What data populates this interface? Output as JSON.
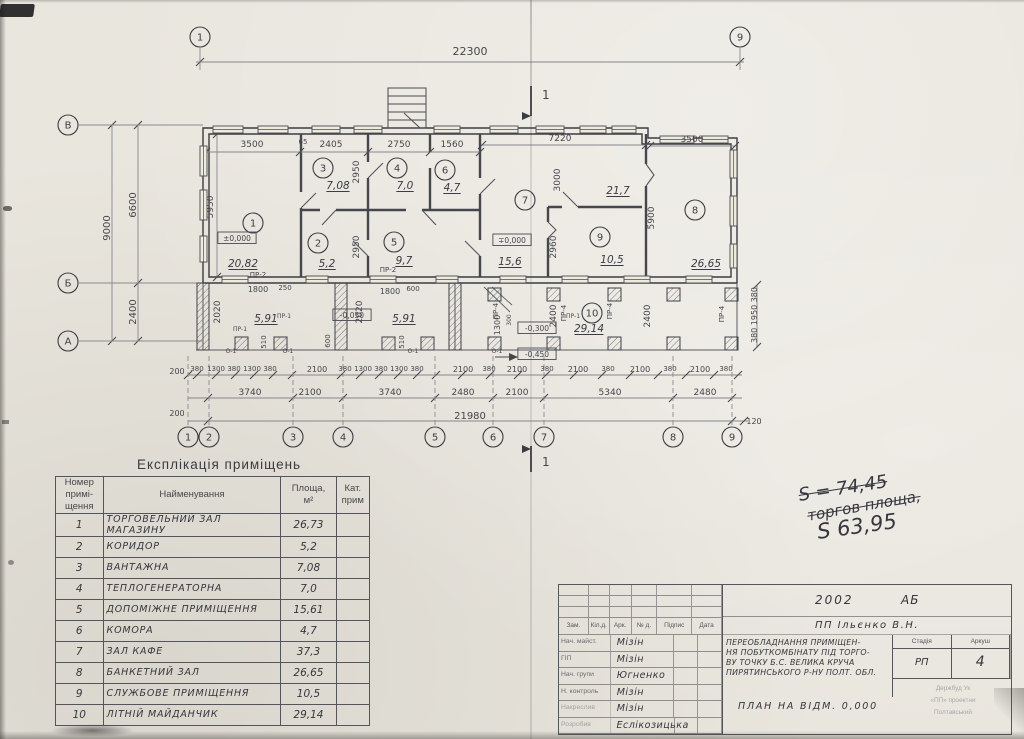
{
  "colors": {
    "paper": "#e9e6de",
    "ink": "#3c3d44",
    "line_light": "#86878c",
    "hand_ink": "#35363e"
  },
  "plan": {
    "overall_width_dim": "22300",
    "section_mark": "1",
    "axes_top": [
      {
        "label": "1",
        "x": 200
      },
      {
        "label": "9",
        "x": 740
      }
    ],
    "axes_bottom": [
      {
        "label": "1",
        "x": 188
      },
      {
        "label": "2",
        "x": 209
      },
      {
        "label": "3",
        "x": 293
      },
      {
        "label": "4",
        "x": 343
      },
      {
        "label": "5",
        "x": 435
      },
      {
        "label": "6",
        "x": 493
      },
      {
        "label": "7",
        "x": 544
      },
      {
        "label": "8",
        "x": 673
      },
      {
        "label": "9",
        "x": 732
      }
    ],
    "axes_left": [
      {
        "label": "В",
        "y": 125
      },
      {
        "label": "Б",
        "y": 283
      },
      {
        "label": "А",
        "y": 341
      }
    ],
    "rooms": [
      {
        "num": "1",
        "cx": 253,
        "cy": 223,
        "area": "20,82",
        "ax": 243,
        "ay": 267
      },
      {
        "num": "2",
        "cx": 318,
        "cy": 243,
        "area": "5,2",
        "ax": 327,
        "ay": 267
      },
      {
        "num": "3",
        "cx": 323,
        "cy": 168,
        "area": "7,08",
        "ax": 338,
        "ay": 189
      },
      {
        "num": "4",
        "cx": 397,
        "cy": 168,
        "area": "7,0",
        "ax": 405,
        "ay": 189
      },
      {
        "num": "5",
        "cx": 394,
        "cy": 242,
        "area": "9,7",
        "ax": 404,
        "ay": 264
      },
      {
        "num": "6",
        "cx": 445,
        "cy": 170,
        "area": "4,7",
        "ax": 452,
        "ay": 191
      },
      {
        "num": "7",
        "cx": 525,
        "cy": 200,
        "area": "15,6",
        "ax": 510,
        "ay": 265
      },
      {
        "num": "8",
        "cx": 695,
        "cy": 210,
        "area": "26,65",
        "ax": 706,
        "ay": 267
      },
      {
        "num": "9",
        "cx": 600,
        "cy": 237,
        "area": "10,5",
        "ax": 612,
        "ay": 263
      },
      {
        "num": "10",
        "cx": 592,
        "cy": 313,
        "area": "29,14",
        "ax": 589,
        "ay": 332
      }
    ],
    "area_labels": [
      {
        "t": "21,7",
        "x": 618,
        "y": 194
      },
      {
        "t": "5,91",
        "x": 266,
        "y": 322
      },
      {
        "t": "5,91",
        "x": 404,
        "y": 322
      }
    ],
    "levels": [
      {
        "t": "±0,000",
        "x": 237,
        "y": 241
      },
      {
        "t": "∓0,000",
        "x": 512,
        "y": 243
      },
      {
        "t": "-0,050",
        "x": 352,
        "y": 318
      },
      {
        "t": "-0,300",
        "x": 537,
        "y": 331
      },
      {
        "t": "-0,450",
        "x": 537,
        "y": 357,
        "arrow": true
      }
    ],
    "dim_labels": [
      {
        "t": "22300",
        "x": 470,
        "y": 55,
        "s": 11
      },
      {
        "t": "3500",
        "x": 252,
        "y": 147,
        "s": 9
      },
      {
        "t": "65",
        "x": 303,
        "y": 144,
        "s": 7
      },
      {
        "t": "2405",
        "x": 331,
        "y": 147,
        "s": 9
      },
      {
        "t": "2750",
        "x": 399,
        "y": 147,
        "s": 9
      },
      {
        "t": "1560",
        "x": 452,
        "y": 147,
        "s": 9
      },
      {
        "t": "7220",
        "x": 560,
        "y": 141,
        "s": 9
      },
      {
        "t": "3500",
        "x": 692,
        "y": 142,
        "s": 9
      },
      {
        "t": "9000",
        "x": 110,
        "y": 228,
        "r": -90,
        "s": 10
      },
      {
        "t": "6600",
        "x": 136,
        "y": 205,
        "r": -90,
        "s": 10
      },
      {
        "t": "2400",
        "x": 136,
        "y": 312,
        "r": -90,
        "s": 10
      },
      {
        "t": "5950",
        "x": 213,
        "y": 207,
        "r": -90,
        "s": 9
      },
      {
        "t": "2950",
        "x": 359,
        "y": 172,
        "r": -90,
        "s": 9
      },
      {
        "t": "2950",
        "x": 359,
        "y": 247,
        "r": -90,
        "s": 9
      },
      {
        "t": "3000",
        "x": 560,
        "y": 180,
        "r": -90,
        "s": 9
      },
      {
        "t": "5900",
        "x": 654,
        "y": 218,
        "r": -90,
        "s": 9
      },
      {
        "t": "2960",
        "x": 556,
        "y": 247,
        "r": -90,
        "s": 9
      },
      {
        "t": "2020",
        "x": 220,
        "y": 312,
        "r": -90,
        "s": 9
      },
      {
        "t": "2020",
        "x": 362,
        "y": 312,
        "r": -90,
        "s": 9
      },
      {
        "t": "2400",
        "x": 556,
        "y": 316,
        "r": -90,
        "s": 9
      },
      {
        "t": "2400",
        "x": 650,
        "y": 316,
        "r": -90,
        "s": 9
      },
      {
        "t": "1300",
        "x": 500,
        "y": 325,
        "r": -90,
        "s": 8
      },
      {
        "t": "300",
        "x": 511,
        "y": 320,
        "r": -90,
        "s": 6
      },
      {
        "t": "1800",
        "x": 258,
        "y": 292,
        "s": 8
      },
      {
        "t": "250",
        "x": 285,
        "y": 290,
        "s": 7
      },
      {
        "t": "1800",
        "x": 390,
        "y": 294,
        "s": 8
      },
      {
        "t": "600",
        "x": 413,
        "y": 291,
        "s": 7
      },
      {
        "t": "510",
        "x": 266,
        "y": 342,
        "r": -90,
        "s": 7
      },
      {
        "t": "510",
        "x": 404,
        "y": 342,
        "r": -90,
        "s": 7
      },
      {
        "t": "600",
        "x": 330,
        "y": 341,
        "r": -90,
        "s": 7
      },
      {
        "t": "380 1950 380",
        "x": 757,
        "y": 315,
        "r": -90,
        "s": 8
      },
      {
        "t": "120",
        "x": 754,
        "y": 424,
        "s": 8
      },
      {
        "t": "200",
        "x": 177,
        "y": 374,
        "s": 8
      },
      {
        "t": "200",
        "x": 177,
        "y": 416,
        "s": 8
      },
      {
        "t": "380",
        "x": 197,
        "y": 371,
        "s": 7
      },
      {
        "t": "1300",
        "x": 216,
        "y": 371,
        "s": 7
      },
      {
        "t": "380",
        "x": 234,
        "y": 371,
        "s": 7
      },
      {
        "t": "1300",
        "x": 252,
        "y": 371,
        "s": 7
      },
      {
        "t": "380",
        "x": 270,
        "y": 371,
        "s": 7
      },
      {
        "t": "2100",
        "x": 317,
        "y": 372,
        "s": 8
      },
      {
        "t": "380",
        "x": 345,
        "y": 371,
        "s": 7
      },
      {
        "t": "1300",
        "x": 363,
        "y": 371,
        "s": 7
      },
      {
        "t": "380",
        "x": 381,
        "y": 371,
        "s": 7
      },
      {
        "t": "1300",
        "x": 399,
        "y": 371,
        "s": 7
      },
      {
        "t": "380",
        "x": 417,
        "y": 371,
        "s": 7
      },
      {
        "t": "2100",
        "x": 463,
        "y": 372,
        "s": 8
      },
      {
        "t": "380",
        "x": 489,
        "y": 371,
        "s": 7
      },
      {
        "t": "2100",
        "x": 517,
        "y": 372,
        "s": 8
      },
      {
        "t": "380",
        "x": 547,
        "y": 371,
        "s": 7
      },
      {
        "t": "2100",
        "x": 578,
        "y": 372,
        "s": 8
      },
      {
        "t": "380",
        "x": 608,
        "y": 371,
        "s": 7
      },
      {
        "t": "2100",
        "x": 640,
        "y": 372,
        "s": 8
      },
      {
        "t": "380",
        "x": 670,
        "y": 371,
        "s": 7
      },
      {
        "t": "2100",
        "x": 700,
        "y": 372,
        "s": 8
      },
      {
        "t": "380",
        "x": 726,
        "y": 371,
        "s": 7
      },
      {
        "t": "3740",
        "x": 250,
        "y": 395,
        "s": 9
      },
      {
        "t": "2100",
        "x": 310,
        "y": 395,
        "s": 9
      },
      {
        "t": "3740",
        "x": 390,
        "y": 395,
        "s": 9
      },
      {
        "t": "2480",
        "x": 463,
        "y": 395,
        "s": 9
      },
      {
        "t": "2100",
        "x": 517,
        "y": 395,
        "s": 9
      },
      {
        "t": "5340",
        "x": 610,
        "y": 395,
        "s": 9
      },
      {
        "t": "2480",
        "x": 705,
        "y": 395,
        "s": 9
      },
      {
        "t": "21980",
        "x": 470,
        "y": 419,
        "s": 10
      }
    ],
    "marks": [
      {
        "t": "ПР-2",
        "x": 258,
        "y": 277,
        "s": 7
      },
      {
        "t": "ПР-2",
        "x": 388,
        "y": 272,
        "s": 7
      },
      {
        "t": "ПР-1",
        "x": 240,
        "y": 331,
        "s": 6
      },
      {
        "t": "ПР-1",
        "x": 284,
        "y": 318,
        "s": 6
      },
      {
        "t": "ПР-1",
        "x": 573,
        "y": 318,
        "s": 6
      },
      {
        "t": "ПР-4",
        "x": 498,
        "y": 311,
        "r": -90,
        "s": 7
      },
      {
        "t": "ПР-4",
        "x": 566,
        "y": 313,
        "r": -90,
        "s": 7
      },
      {
        "t": "ПР-4",
        "x": 612,
        "y": 311,
        "r": -90,
        "s": 7
      },
      {
        "t": "ПР-4",
        "x": 724,
        "y": 314,
        "r": -90,
        "s": 7
      },
      {
        "t": "О-1",
        "x": 231,
        "y": 353,
        "s": 6
      },
      {
        "t": "О-1",
        "x": 288,
        "y": 353,
        "s": 6
      },
      {
        "t": "О-1",
        "x": 413,
        "y": 353,
        "s": 6
      },
      {
        "t": "О-1",
        "x": 497,
        "y": 353,
        "s": 6
      }
    ]
  },
  "table": {
    "title": "Експлікація приміщень",
    "headers": {
      "num": "Номер\nпримі-\nщення",
      "name": "Найменування",
      "area": "Площа,\nм²",
      "cat": "Кат.\nприм"
    },
    "rows": [
      [
        "1",
        "Торговельний зал магазину",
        "26,73"
      ],
      [
        "2",
        "Коридор",
        "5,2"
      ],
      [
        "3",
        "Вантажна",
        "7,08"
      ],
      [
        "4",
        "Теплогенераторна",
        "7,0"
      ],
      [
        "5",
        "Допоміжне приміщення",
        "15,61"
      ],
      [
        "6",
        "Комора",
        "4,7"
      ],
      [
        "7",
        "Зал кафе",
        "37,3"
      ],
      [
        "8",
        "Банкетний зал",
        "26,65"
      ],
      [
        "9",
        "Службове приміщення",
        "10,5"
      ],
      [
        "10",
        "Літній майданчик",
        "29,14"
      ]
    ]
  },
  "notes": {
    "line1": "S = 74,45",
    "line2": "торгов площа,",
    "line3": "S 63,95"
  },
  "title_block": {
    "year": "2002",
    "code": "АБ",
    "firm": "ПП Ільєнко В.Н.",
    "cols": [
      "Зам.",
      "Кіл.д.",
      "Арк.",
      "№ д.",
      "Підпис",
      "Дата"
    ],
    "staff": [
      [
        "Нач. майст.",
        "Мізін"
      ],
      [
        "ГІП",
        "Мізін"
      ],
      [
        "Нач. групи",
        "Югненко"
      ],
      [
        "Н. контроль",
        "Мізін"
      ],
      [
        "Накреслив",
        "Мізін"
      ],
      [
        "Розробив",
        "Еслікозицька"
      ]
    ],
    "project_lines": [
      "Переобладнання приміщен-",
      "ня побуткомбінату під торго-",
      "ву точку б.с. Велика Круча",
      "Пирятинського р-ну Полт. обл."
    ],
    "stage_label": "Стадія",
    "stage": "РП",
    "sheet_label": "Аркуш",
    "sheet": "4",
    "plan_title": "План на відм. 0,000",
    "faint_lines": [
      "Держбуд Ук",
      "«ПП» проектни",
      "Полтавський"
    ]
  }
}
